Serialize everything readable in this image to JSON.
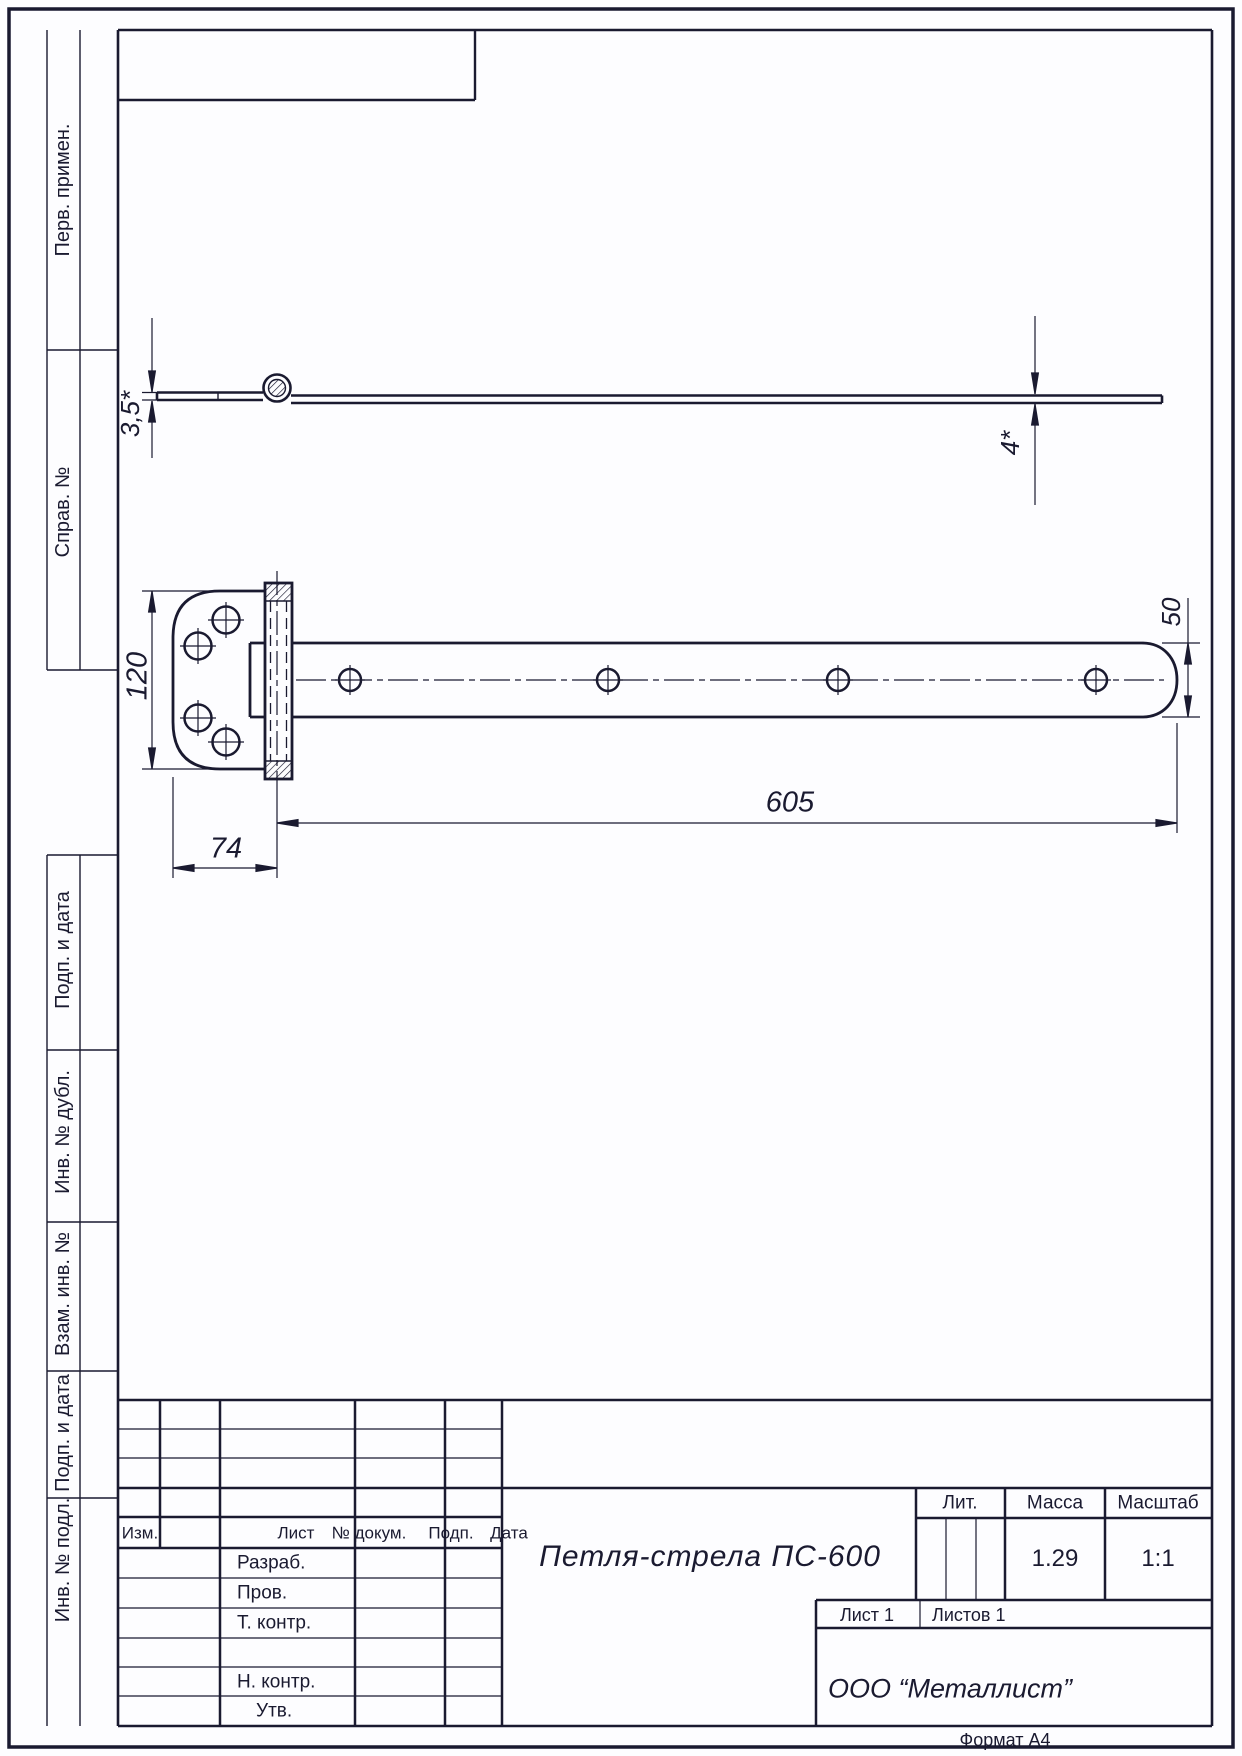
{
  "page": {
    "format_note": "Формат А4"
  },
  "margin_labels": [
    "Перв. примен.",
    "Справ. №",
    "Подп. и дата",
    "Инв. № дубл.",
    "Взам. инв. №",
    "Подп. и дата",
    "Инв. № подл."
  ],
  "dimensions": {
    "plate_thickness": "3,5*",
    "strap_thickness": "4*",
    "plate_height": "120",
    "plate_width": "74",
    "strap_length": "605",
    "strap_end_width": "50"
  },
  "title_block": {
    "header_cols": [
      "Изм.",
      "Лист",
      "№ докум.",
      "Подп.",
      "Дата"
    ],
    "role_rows": [
      "Разраб.",
      "Пров.",
      "Т. контр.",
      "Н. контр.",
      "Утв."
    ],
    "title": "Петля-стрела ПС-600",
    "lit_label": "Лит.",
    "mass_label": "Масса",
    "scale_label": "Масштаб",
    "mass_value": "1.29",
    "scale_value": "1:1",
    "sheet_label": "Лист 1",
    "sheets_label": "Листов 1",
    "organization": "ООО “Металлист”"
  }
}
